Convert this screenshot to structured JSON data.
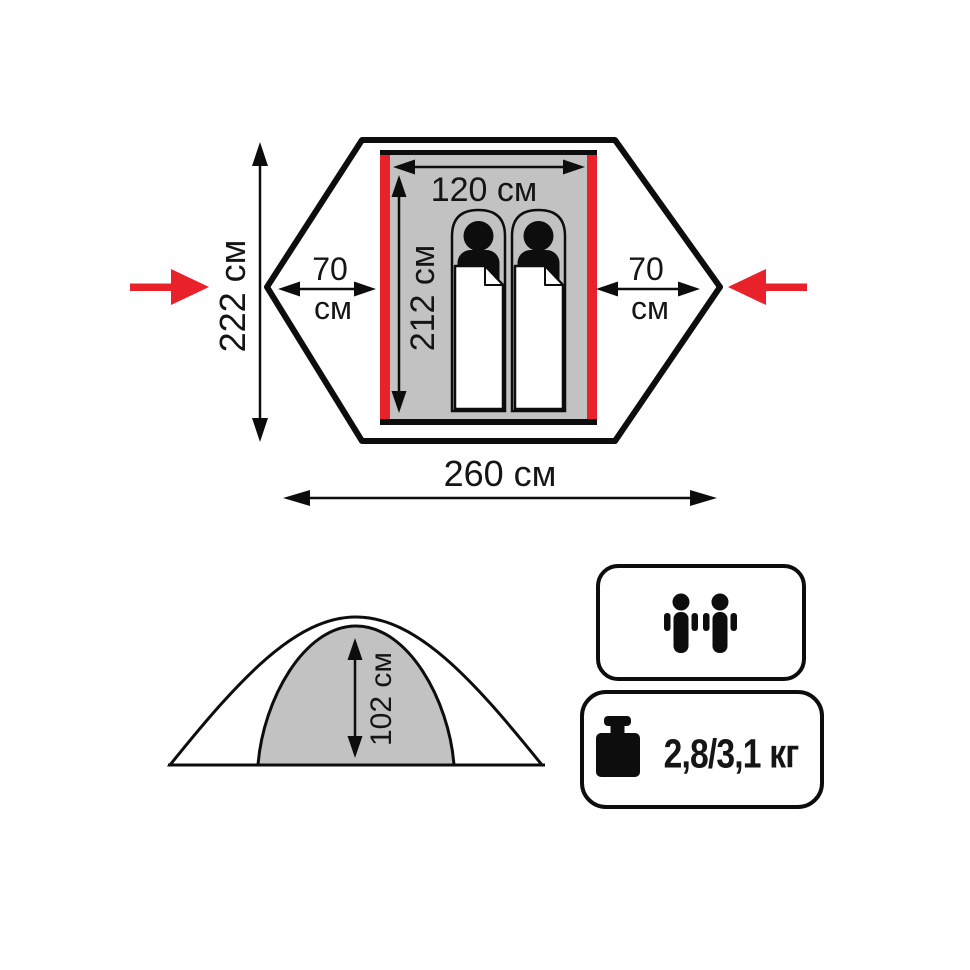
{
  "diagram_title": "tent dimensions diagram",
  "colors": {
    "accent_red": "#e8212b",
    "inner_gray": "#c2c2c2",
    "line_black": "#0d0d0d"
  },
  "top_view": {
    "total_width_label": "222 см",
    "total_length_label": "260 см",
    "inner_width_label": "120 см",
    "inner_length_label": "212 см",
    "vestibule_left_value": "70",
    "vestibule_left_unit": "см",
    "vestibule_right_value": "70",
    "vestibule_right_unit": "см"
  },
  "side_view": {
    "inner_height_label": "102 см"
  },
  "specs": {
    "capacity_persons": 2,
    "weight_label": "2,8/3,1 кг"
  }
}
